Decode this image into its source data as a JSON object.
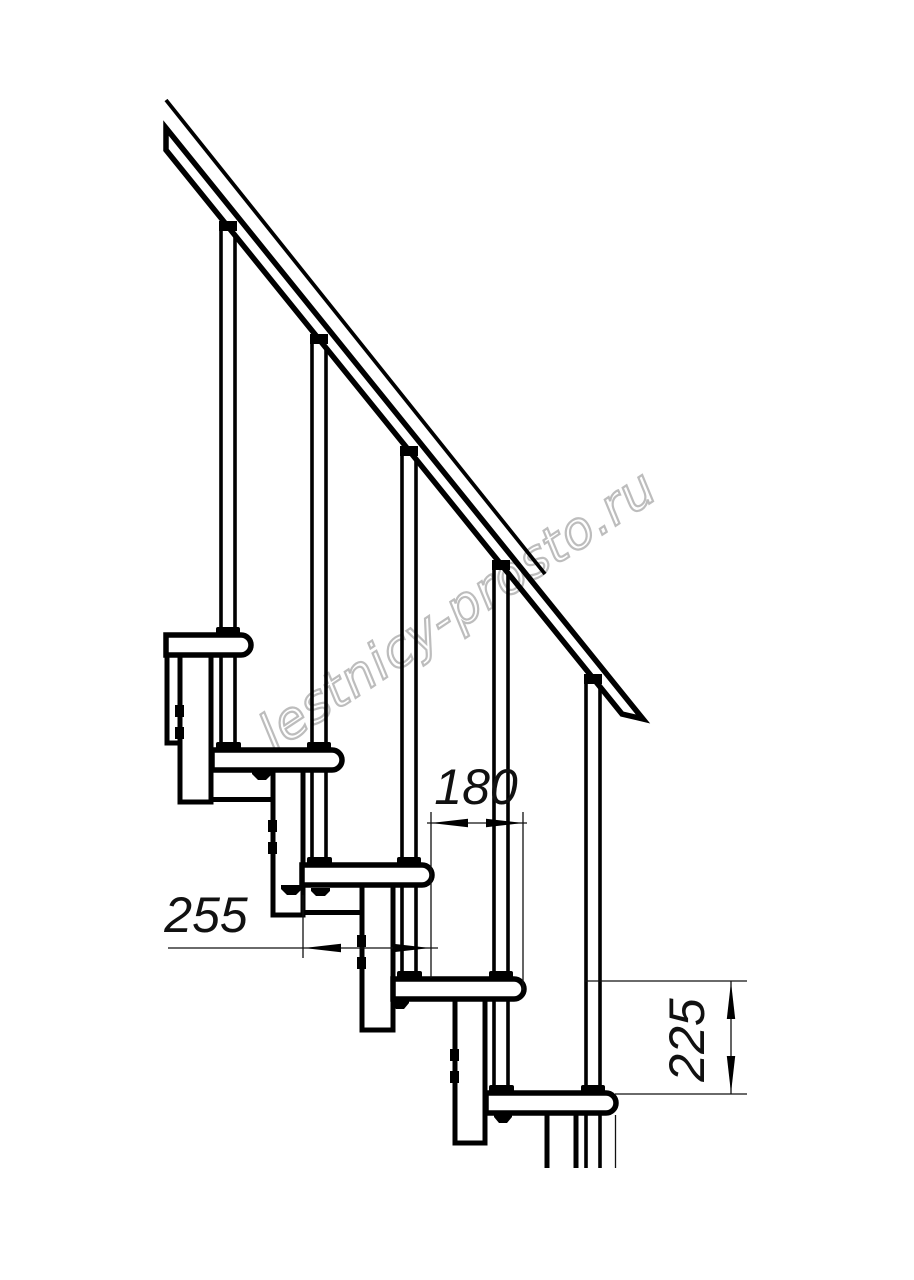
{
  "page": {
    "background": "#ffffff",
    "line_color": "#000000"
  },
  "watermark": {
    "text": "lestnicy-prosto.ru",
    "color": "#bdbdbd"
  },
  "dimensions": {
    "run": {
      "label": "180",
      "orientation": "horizontal"
    },
    "depth": {
      "label": "255",
      "orientation": "horizontal"
    },
    "rise": {
      "label": "225",
      "orientation": "vertical"
    }
  },
  "drawing": {
    "kind": "modular staircase side view fragment",
    "treads_visible": 5,
    "balusters_visible": 5
  }
}
